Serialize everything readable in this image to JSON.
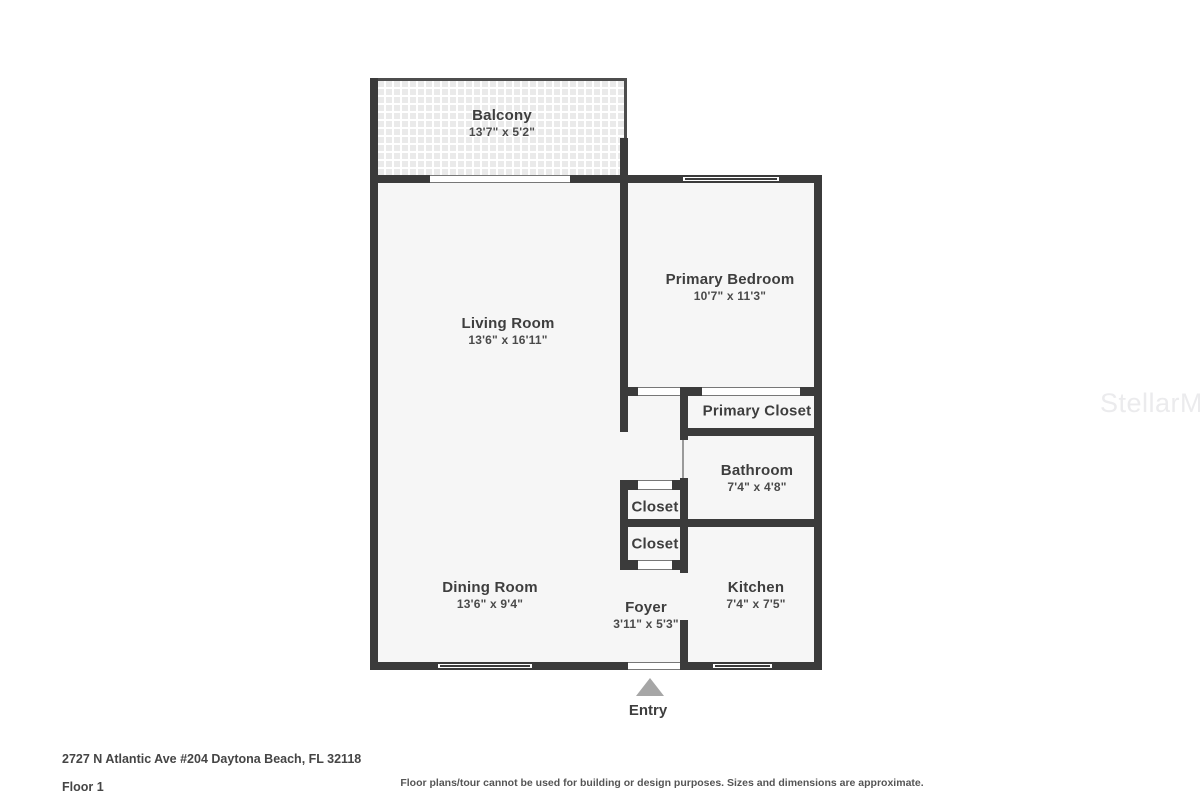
{
  "watermark": "StellarMLS",
  "rooms": {
    "balcony": {
      "name": "Balcony",
      "dims": "13'7\" x 5'2\""
    },
    "living": {
      "name": "Living Room",
      "dims": "13'6\" x 16'11\""
    },
    "bedroom": {
      "name": "Primary Bedroom",
      "dims": "10'7\" x 11'3\""
    },
    "primary_closet": {
      "name": "Primary Closet"
    },
    "bathroom": {
      "name": "Bathroom",
      "dims": "7'4\" x 4'8\""
    },
    "closet1": {
      "name": "Closet"
    },
    "closet2": {
      "name": "Closet"
    },
    "kitchen": {
      "name": "Kitchen",
      "dims": "7'4\" x 7'5\""
    },
    "dining": {
      "name": "Dining Room",
      "dims": "13'6\" x 9'4\""
    },
    "foyer": {
      "name": "Foyer",
      "dims": "3'11\" x 5'3\""
    }
  },
  "entry": {
    "label": "Entry"
  },
  "footer": {
    "address": "2727 N Atlantic Ave #204 Daytona Beach, FL 32118",
    "floor": "Floor 1",
    "disclaimer": "Floor plans/tour cannot be used for building or design purposes. Sizes and dimensions are approximate."
  },
  "colors": {
    "wall": "#3b3b3b",
    "room_fill": "#f6f6f6",
    "label_text": "#3e3e3e",
    "entry_arrow": "#a6a6a6",
    "watermark": "#ebebed"
  }
}
